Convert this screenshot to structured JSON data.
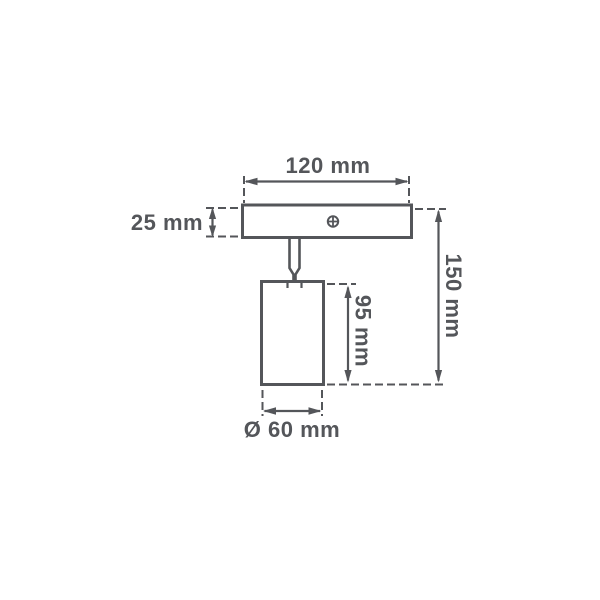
{
  "page": {
    "background_color": "#ffffff"
  },
  "drawing": {
    "kind": "spotlight-fixture-dimension-diagram",
    "line_color": "#54565a",
    "labels": {
      "width": "120 mm",
      "plate_height": "25 mm",
      "overall_height": "150 mm",
      "body_height": "95 mm",
      "body_diameter": "Ø 60 mm"
    },
    "icons": {
      "screw_head": "screw-head-icon"
    }
  }
}
